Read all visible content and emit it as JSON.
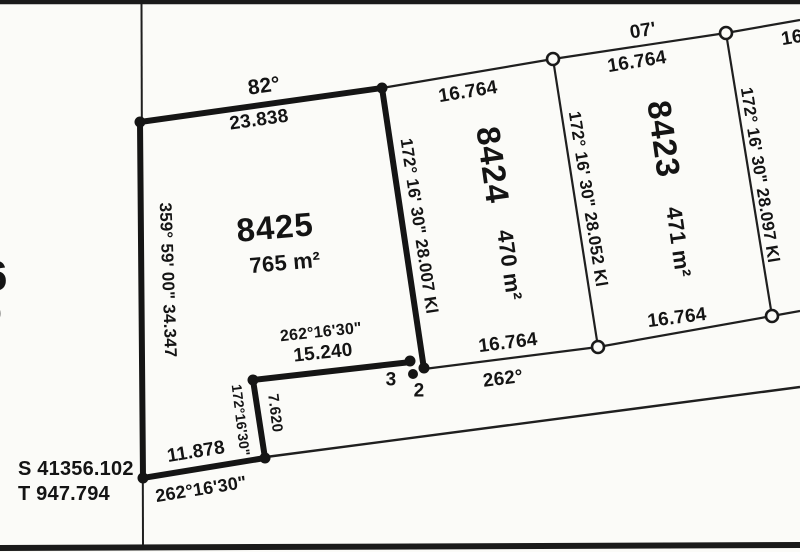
{
  "plan": {
    "parcels": {
      "p8425": {
        "id": "8425",
        "area": "765 m²"
      },
      "p8424": {
        "id": "8424",
        "area": "470 m²"
      },
      "p8423": {
        "id": "8423",
        "area": "471 m²"
      }
    },
    "boundaries": {
      "top_8425_bearing": "82°",
      "top_8425_distance": "23.838",
      "left_8425": "359° 59' 00\" 34.347",
      "right_8425": "172° 16' 30\" 28.007 Kl",
      "divider_8424_8423": "172° 16' 30\" 28.052 Kl",
      "right_8423": "172° 16' 30\" 28.097 Kl",
      "step_top_bearing": "262°16'30\"",
      "step_top_distance": "15.240",
      "step_side_bearing": "172°16'30\"",
      "step_side_distance": "7.620",
      "bottom_8425_distance": "11.878",
      "bottom_8425_bearing": "262°16'30\"",
      "front_8424_distance": "16.764",
      "front_8424_bearing": "262°",
      "front_8423_distance": "16.764",
      "top_8424_distance": "16.764",
      "top_8423_distance": "16.764",
      "top_8423_bearing_partial": "07'",
      "top_right_partial": "16"
    },
    "points": {
      "p2": "2",
      "p3": "3"
    },
    "reference": {
      "s_value": "S 41356.102",
      "t_value": "T 947.794"
    },
    "edge_cut": {
      "big": "6",
      "small": "0"
    }
  }
}
